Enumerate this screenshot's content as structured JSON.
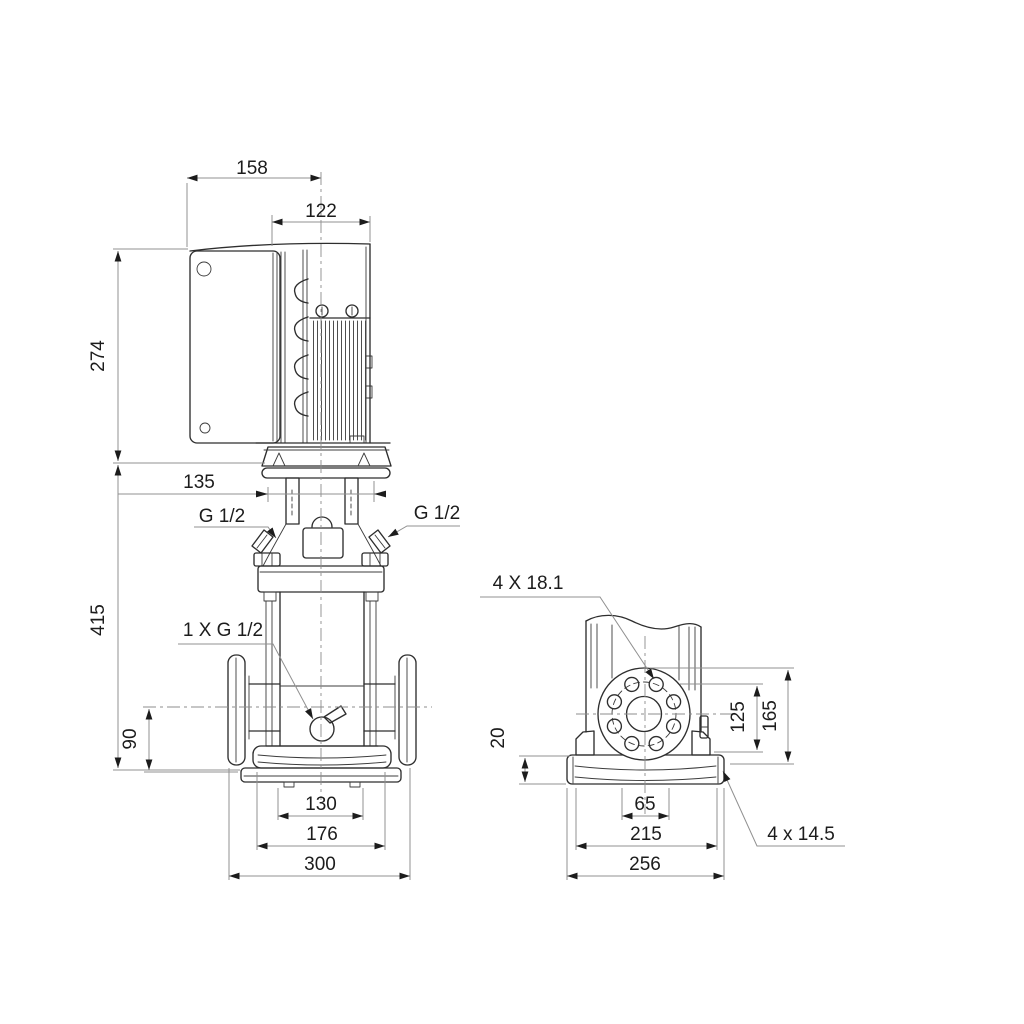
{
  "front": {
    "d158": "158",
    "d122": "122",
    "d274": "274",
    "d135": "135",
    "d415": "415",
    "d90": "90",
    "vent_left": "G 1/2",
    "vent_right": "G 1/2",
    "drain": "1 X G 1/2",
    "d130": "130",
    "d176": "176",
    "d300": "300"
  },
  "side": {
    "flange_holes": "4 X 18.1",
    "d125": "125",
    "d165": "165",
    "d20": "20",
    "d65": "65",
    "d215": "215",
    "d256": "256",
    "base_holes": "4 x 14.5"
  },
  "style": {
    "part_color": "#2e2e2e",
    "dimension_color": "#909090",
    "text_color": "#1c1c1c",
    "background": "#ffffff"
  }
}
